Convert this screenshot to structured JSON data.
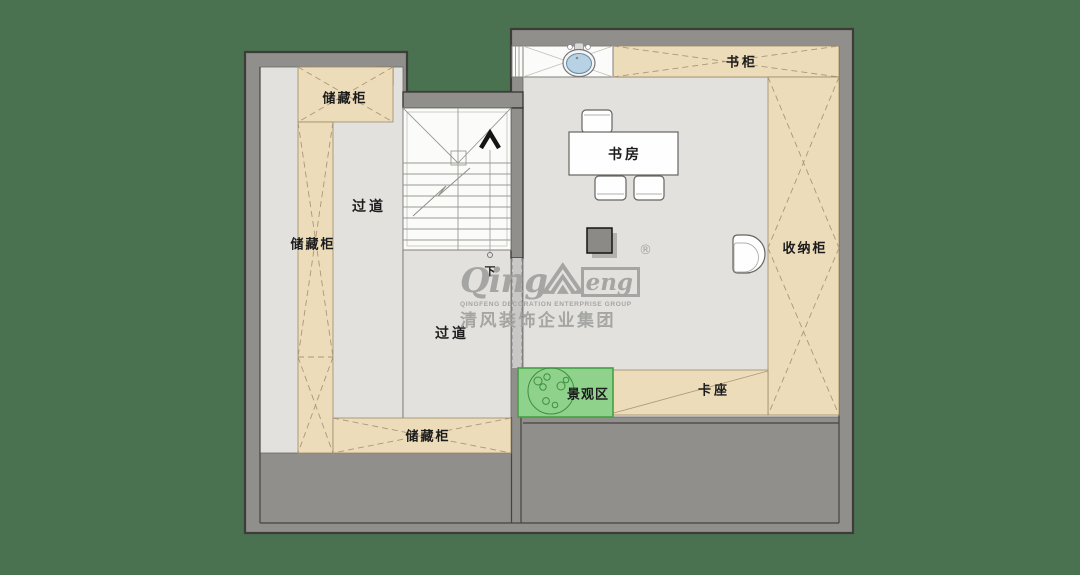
{
  "colors": {
    "background": "#4a7150",
    "wall": "#908f8b",
    "wall_outline": "#3d3c38",
    "floor": "#e2e1de",
    "cabinet": "#ecdcba",
    "cabinet_line": "#ad9678",
    "stair_white": "#fbfbf9",
    "landscape_green": "#8fd28c",
    "landscape_border": "#45a045",
    "sink_blue": "#b7d2e4",
    "watermark": "#a2a2a0"
  },
  "labels": {
    "storage_top": "储藏柜",
    "storage_left": "储藏柜",
    "storage_bottom": "储藏柜",
    "corridor_upper": "过道",
    "corridor_lower": "过道",
    "bookcase": "书柜",
    "study": "书房",
    "organizer": "收纳柜",
    "booth": "卡座",
    "landscape": "景观区",
    "stairs_down": "下"
  },
  "watermark": {
    "latin_prefix": "Qing",
    "latin_suffix": "eng",
    "registered": "®",
    "tagline": "QINGFENG  DECORATION  ENTERPRISE  GROUP",
    "chinese": "清风装饰企业集团"
  }
}
